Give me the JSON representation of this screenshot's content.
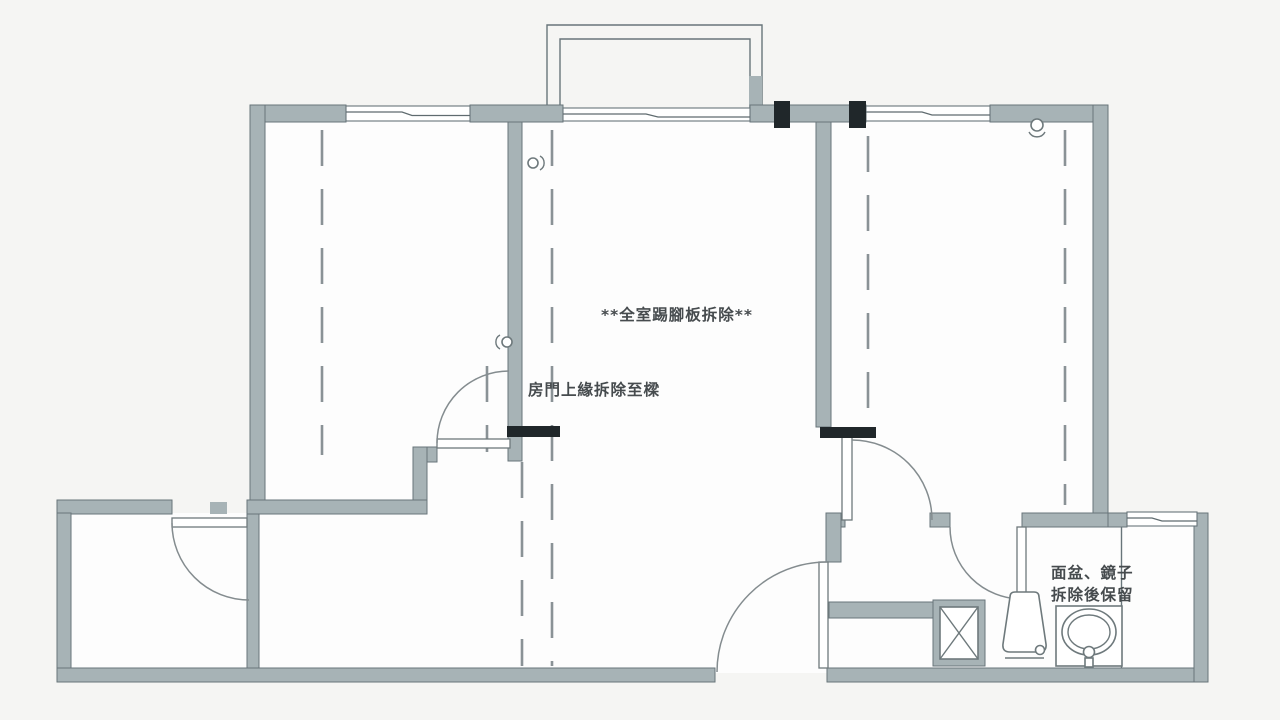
{
  "document": {
    "type": "demolition-floor-plan",
    "language": "zh-Hant"
  },
  "annotations": {
    "skirting_removal": "**全室踢腳板拆除**",
    "door_lintel_removal": "房門上緣拆除至樑",
    "basin_mirror_line1": "面盆、鏡子",
    "basin_mirror_line2": "拆除後保留"
  },
  "symbols": {
    "demolition_marker": "black solid bar on wall",
    "dashed_line": "demolished / to-be-removed partition line",
    "shaft": "shaft-x-icon",
    "toilet": "toilet-icon",
    "basin": "sink-icon",
    "door": "door-swing-icon",
    "window": "window-icon",
    "wall_fixture": "wall-fixture-icon"
  },
  "colors": {
    "paper": "#f5f5f3",
    "floor": "#fdfdfd",
    "wall-fill": "#a7b3b6",
    "wall-edge": "#68757a",
    "dash": "#8a9296",
    "marker": "#20272a",
    "text": "#464b4e"
  }
}
